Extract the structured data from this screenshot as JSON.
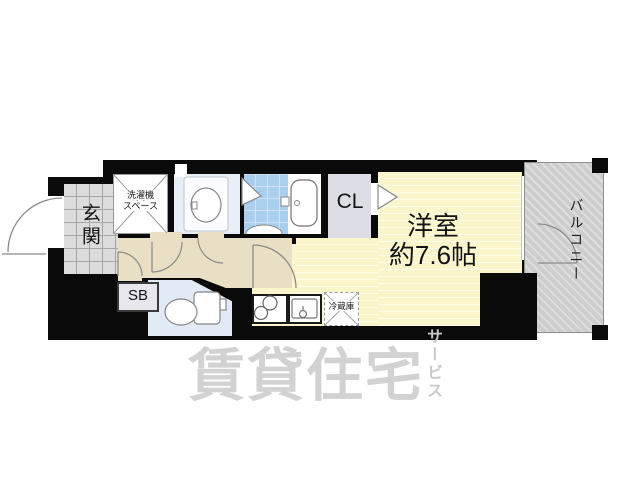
{
  "floorplan": {
    "entrance": {
      "label": "玄関"
    },
    "washer_space": {
      "label_line1": "洗濯機",
      "label_line2": "スペース"
    },
    "closet": {
      "label": "CL"
    },
    "main_room": {
      "label_line1": "洋室",
      "label_line2": "約7.6帖"
    },
    "shoe_box": {
      "label": "SB"
    },
    "refrigerator": {
      "label": "冷蔵庫"
    },
    "balcony": {
      "label": "バルコニー"
    },
    "colors": {
      "wall": "#0a0a0a",
      "main_room_floor": "#fbf5cc",
      "hallway_floor": "#e9dfc4",
      "bath_tile": "#a9ceee",
      "washroom_floor": "#e8eff8",
      "closet_floor": "#dddde6",
      "entrance_tile": "#dcdcdc",
      "balcony_floor": "#cdcdcd",
      "watermark": "#d2d2d2"
    }
  },
  "watermark": {
    "main": "賃貸住宅",
    "sub": "サービス"
  }
}
